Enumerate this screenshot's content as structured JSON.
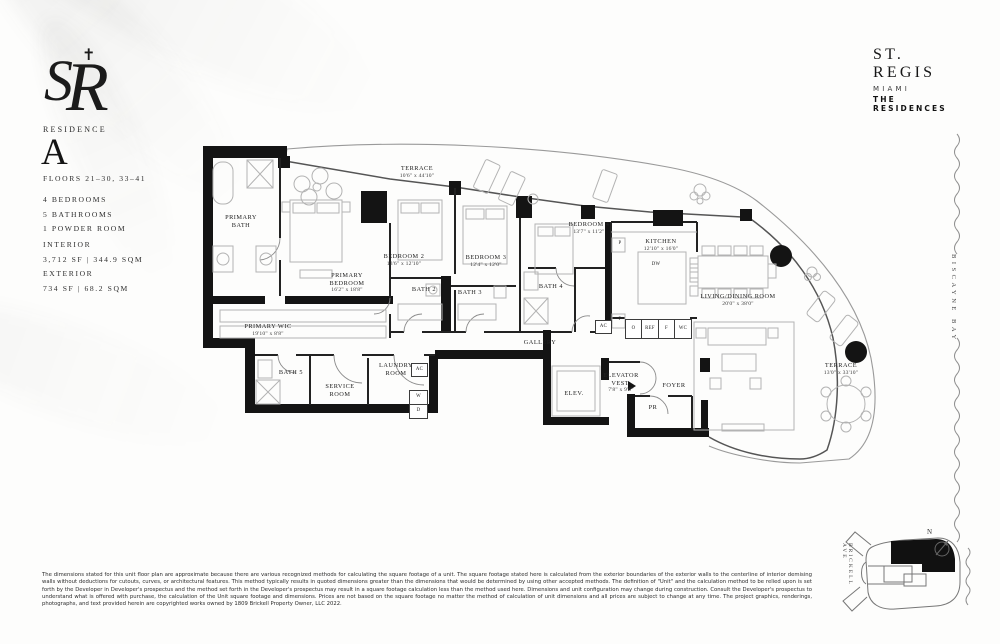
{
  "brand": {
    "monogram": "SR",
    "name": "ST. REGIS",
    "city": "MIAMI",
    "residences": "THE RESIDENCES"
  },
  "residence": {
    "label": "RESIDENCE",
    "letter": "A",
    "floors": "FLOORS 21–30, 33–41",
    "features": {
      "f1": "4 BEDROOMS",
      "f2": "5 BATHROOMS",
      "f3": "1 POWDER ROOM"
    },
    "interior_label": "INTERIOR",
    "interior_value": "3,712 SF | 344.9 SQM",
    "exterior_label": "EXTERIOR",
    "exterior_value": "734 SF | 68.2 SQM"
  },
  "plan": {
    "rooms": {
      "terrace_top": {
        "name": "TERRACE",
        "dims": "10'6\" x 44'10\""
      },
      "primary_bath": {
        "name": "PRIMARY BATH"
      },
      "primary_bedroom": {
        "name": "PRIMARY BEDROOM",
        "dims": "16'2\" x 18'8\""
      },
      "primary_wic": {
        "name": "PRIMARY WIC",
        "dims": "19'10\" x 8'8\""
      },
      "bedroom_2": {
        "name": "BEDROOM 2",
        "dims": "13'6\" x 12'10\""
      },
      "bath_2": {
        "name": "BATH 2"
      },
      "bedroom_3": {
        "name": "BEDROOM 3",
        "dims": "12'4\" x 12'0\""
      },
      "bath_3": {
        "name": "BATH 3"
      },
      "bedroom_4": {
        "name": "BEDROOM 4",
        "dims": "13'7\" x 11'2\""
      },
      "bath_4": {
        "name": "BATH 4"
      },
      "kitchen": {
        "name": "KITCHEN",
        "dims": "12'10\" x 16'0\""
      },
      "living_dining": {
        "name": "LIVING/DINING ROOM",
        "dims": "20'0\" x 38'0\""
      },
      "terrace_right": {
        "name": "TERRACE",
        "dims": "13'0\" x 33'10\""
      },
      "gallery": {
        "name": "GALLERY"
      },
      "bath_5": {
        "name": "BATH 5"
      },
      "service_room": {
        "name": "SERVICE ROOM"
      },
      "laundry_room": {
        "name": "LAUNDRY ROOM"
      },
      "elevator": {
        "name": "ELEV."
      },
      "elevator_vest": {
        "name": "ELEVATOR VEST.",
        "dims": "7'8\" x 9'6\""
      },
      "foyer": {
        "name": "FOYER"
      },
      "powder_room": {
        "name": "PR"
      }
    },
    "fixtures": {
      "ac": "AC",
      "w": "W",
      "d": "D",
      "p": "P",
      "dw": "DW",
      "o": "O",
      "ref": "REF",
      "f": "F",
      "wc": "WC"
    }
  },
  "map": {
    "street": "BRICKELL AVE",
    "bay": "BISCAYNE BAY",
    "north": "N"
  },
  "disclaimer": "The dimensions stated for this unit floor plan are approximate because there are various recognized methods for calculating the square footage of a unit. The square footage stated here is calculated from the exterior boundaries of the exterior walls to the centerline of interior demising walls without deductions for cutouts, curves, or architectural features. This method typically results in quoted dimensions greater than the dimensions that would be determined by using other accepted methods. The definition of \"Unit\" and the calculation method to be relied upon is set forth by the Developer in Developer's prospectus and the method set forth in the Developer's prospectus may result in a square footage calculation less than the method used here. Dimensions and unit configuration may change during construction. Consult the Developer's prospectus to understand what is offered with purchase, the calculation of the Unit square footage and dimensions. Prices are not based on the square footage no matter the method of calculation of unit dimensions and all prices are subject to change at any time. The project graphics, renderings, photographs, and text provided herein are copyrighted works owned by 1809 Brickell Property Owner, LLC 2022."
}
